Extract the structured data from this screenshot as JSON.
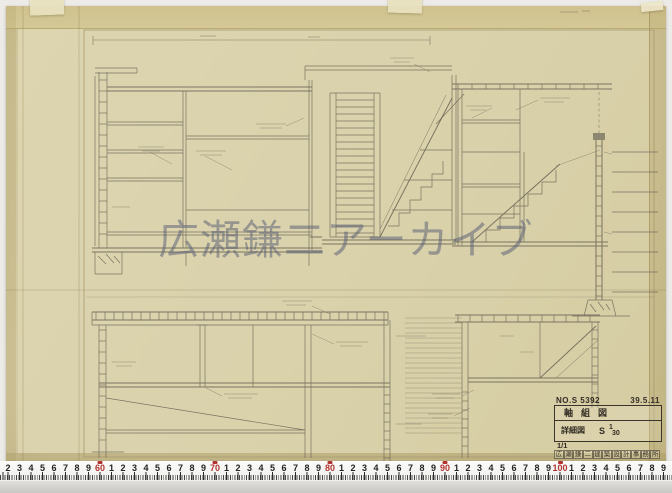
{
  "photo": {
    "backdrop_color": "#ecebe7",
    "paper_color": "#d9d0a9",
    "pencil_color": "#6a6455"
  },
  "watermark": {
    "text": "広瀬鎌二アーカイブ",
    "color": "rgba(88,94,116,0.52)"
  },
  "title_block": {
    "no_label": "NO.S 5392",
    "date": "39.5.11",
    "row1": "軸組図",
    "row2_label": "詳細図",
    "scale_letter": "S",
    "scale_num": "1",
    "scale_den": "30",
    "sheet_note": "1/1",
    "stamp": "広瀬鎌二建築設計事務所"
  },
  "ruler": {
    "origin_x": 8,
    "step_px": 11.5,
    "start_value": 52,
    "count": 58,
    "number_color": "#232323",
    "decade_color": "#b23430"
  }
}
